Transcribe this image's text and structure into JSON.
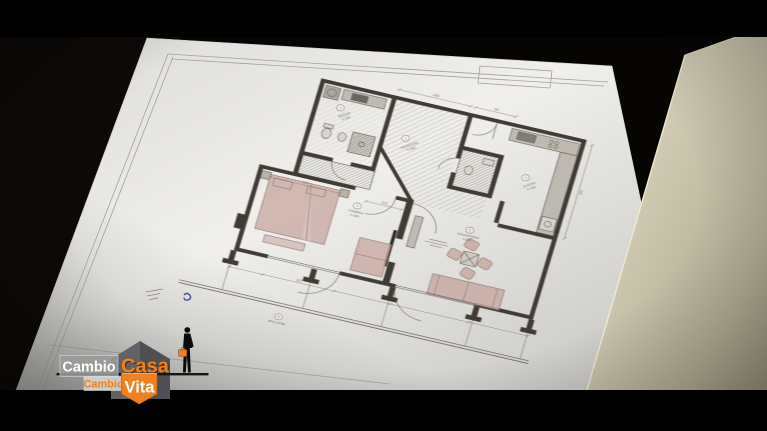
{
  "show_logo": {
    "word1": "Cambio",
    "word2": "Casa",
    "word3": "Cambio",
    "word4": "Vita",
    "orange": "#ee8220",
    "roof_gray": "#5c5c60"
  },
  "floorplan": {
    "rooms": [
      {
        "num": "1",
        "name": "INGRESSO",
        "height": "h 240"
      },
      {
        "num": "2",
        "name": "BAGNO",
        "height": "h 240"
      },
      {
        "num": "3",
        "name": "CUCINA",
        "height": "h 240"
      },
      {
        "num": "4",
        "name": "CAMERA",
        "height": "h 290"
      },
      {
        "num": "5",
        "name": "SOGGIORNO",
        "height": "h 290"
      },
      {
        "num": "6",
        "name": "BALCONE",
        "height": ""
      }
    ],
    "dimensions": {
      "bed": "210",
      "camera_top": "112",
      "top_center": "144",
      "top_right": "90",
      "right_side": "260",
      "balcony": "110"
    }
  }
}
